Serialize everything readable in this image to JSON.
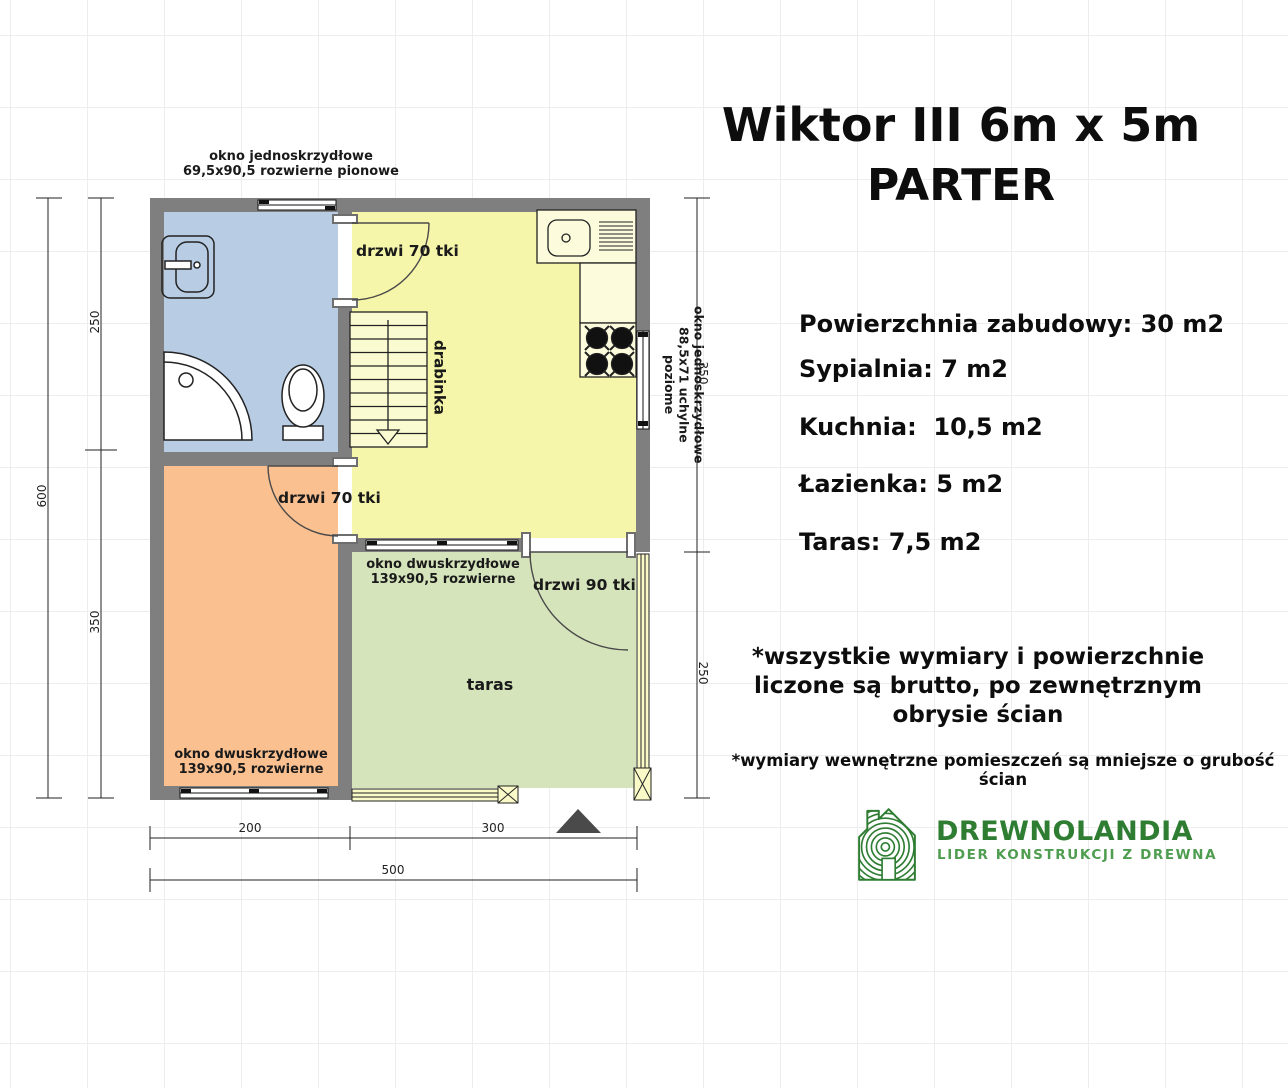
{
  "title": {
    "line1": "Wiktor III 6m x 5m",
    "line2": "PARTER"
  },
  "specs": {
    "building_area": "Powierzchnia zabudowy: 30 m2",
    "bedroom": "Sypialnia: 7 m2",
    "kitchen": "Kuchnia:  10,5 m2",
    "bathroom": "Łazienka: 5 m2",
    "terrace": "Taras: 7,5 m2"
  },
  "notes": {
    "main_line1": "*wszystkie wymiary i powierzchnie",
    "main_line2": "liczone są brutto, po zewnętrznym",
    "main_line3": "obrysie ścian",
    "secondary": "*wymiary wewnętrzne pomieszczeń są mniejsze o grubość ścian"
  },
  "logo": {
    "name": "DREWNOLANDIA",
    "tagline": "LIDER KONSTRUKCJI Z DREWNA"
  },
  "plan": {
    "labels": {
      "top_window_line1": "okno jednoskrzydłowe",
      "top_window_line2": "69,5x90,5 rozwierne pionowe",
      "kitchen_door": "drzwi 70 tki",
      "bedroom_door": "drzwi 70 tki",
      "terrace_door": "drzwi 90 tki",
      "ladder": "drabinka",
      "right_window_line1": "okno jednoskrzydłowe",
      "right_window_line2": "88,5x71 uchylne poziome",
      "terrace_window_line1": "okno dwuskrzydłowe",
      "terrace_window_line2": "139x90,5 rozwierne",
      "bedroom_window_line1": "okno dwuskrzydłowe",
      "bedroom_window_line2": "139x90,5 rozwierne",
      "terrace": "taras"
    },
    "dimensions": {
      "left_total": "600",
      "left_top": "250",
      "left_bottom": "350",
      "right_top": "350",
      "right_bottom": "250",
      "bottom_left": "200",
      "bottom_right": "300",
      "bottom_total": "500"
    }
  },
  "colors": {
    "wall": "#7f7f7f",
    "bathroom_floor": "#b8cce4",
    "bedroom_floor": "#fac090",
    "kitchen_floor": "#f6f6aa",
    "terrace_floor": "#d6e4bc",
    "logo_green": "#2e7d32",
    "marker_gray": "#4a4a4a"
  }
}
